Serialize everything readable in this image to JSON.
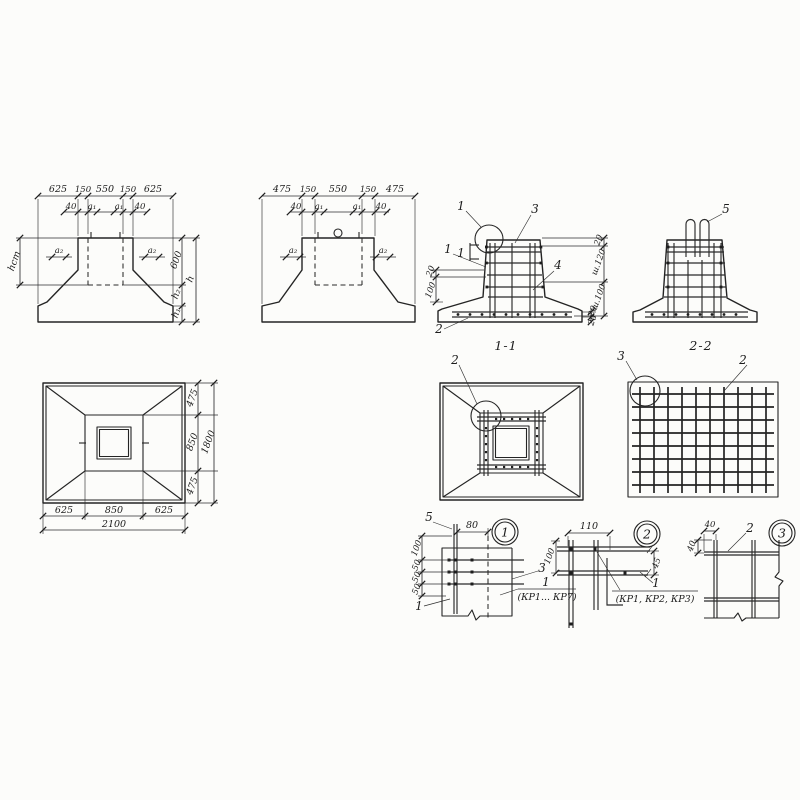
{
  "section_a": {
    "top": [
      "625",
      "150",
      "550",
      "150",
      "625"
    ],
    "offsets": [
      "40",
      "a₁",
      "a₁",
      "40"
    ],
    "left_h": "hст",
    "a2l": "a₂",
    "a2r": "a₂",
    "right": [
      "600",
      "h₂",
      "h₁"
    ],
    "h": "h"
  },
  "section_b": {
    "top": [
      "475",
      "150",
      "550",
      "150",
      "475"
    ],
    "offsets": [
      "40",
      "a₁",
      "a₁",
      "40"
    ],
    "a2l": "a₂",
    "a2r": "a₂"
  },
  "section_11": {
    "caption": "1-1",
    "co_1": "1",
    "co_3": "3",
    "co_4": "4",
    "co_1b": "1",
    "co_2": "2",
    "cut": "1",
    "right": [
      "20",
      "ш.120",
      "ш.100"
    ],
    "left": [
      "20",
      "100"
    ],
    "base": [
      "20",
      "20"
    ]
  },
  "section_22": {
    "caption": "2-2",
    "co_5": "5"
  },
  "plan_a": {
    "bottom": [
      "625",
      "850",
      "625"
    ],
    "total_b": "2100",
    "right": [
      "475",
      "850",
      "475"
    ],
    "total_r": "1800"
  },
  "plan_b": {
    "co_2": "2"
  },
  "plan_c": {
    "co_3": "3",
    "co_2": "2"
  },
  "det1": {
    "badge": "1",
    "top": "80",
    "left": [
      "100",
      "50",
      "50",
      "50"
    ],
    "co5": "5",
    "co3": "3",
    "co1": "1",
    "num": "1",
    "marks": "(КР1... КР7)"
  },
  "det2": {
    "badge": "2",
    "top": "110",
    "left": "100",
    "right": "45",
    "num": "1",
    "marks": "(КР1, КР2, КР3)"
  },
  "det3": {
    "badge": "3",
    "top": "40",
    "left": "40",
    "co2": "2"
  }
}
